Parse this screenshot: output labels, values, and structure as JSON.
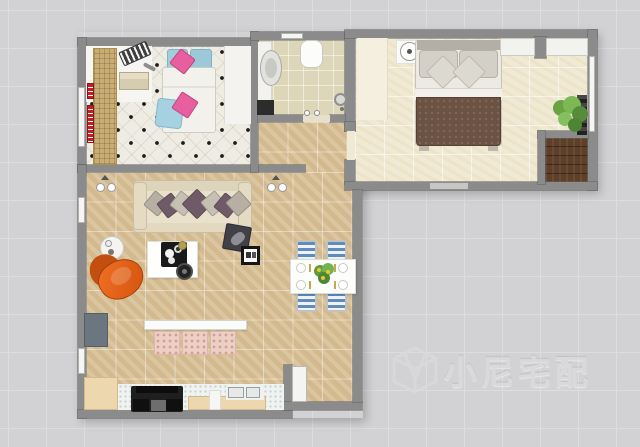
{
  "canvas": {
    "type": "home-design-floor-plan",
    "watermark_text": "小尼宅配",
    "background_color": "#d2d2d4",
    "grid_color": "#dddddf"
  },
  "palette": {
    "wall": "#8b8b8b",
    "living_floor": "#d8c097",
    "left_bedroom_floor": "#efece4",
    "right_bedroom_floor": "#f0e9d3",
    "bathroom_floor": "#ddd6b8",
    "balcony_wood": "#5e3f27",
    "sofa_cream": "#e9e1cb",
    "pillow_purple": "#6f5a67",
    "armchair_orange": "#e2601a",
    "bed_blanket_brown": "#6b5243",
    "pillow_pink": "#e75f9f",
    "pillow_blue": "#a2cddb",
    "dining_chair_blue": "#5f8cba",
    "red_wall_rack": "#c51f26",
    "tv_gray": "#6b7680",
    "counter_wood": "#ecd7ae"
  },
  "rooms": [
    {
      "name": "left-bedroom",
      "furniture": [
        "single-bed",
        "blue-pillows",
        "pink-pillows",
        "desk",
        "keyboard",
        "bench",
        "wicker-shelf",
        "red-wall-rack",
        "wardrobe",
        "window"
      ]
    },
    {
      "name": "bathroom",
      "furniture": [
        "vanity-counter",
        "washbasin",
        "bathtub",
        "shower-head",
        "bath-mat",
        "door-opening",
        "window"
      ]
    },
    {
      "name": "right-bedroom",
      "furniture": [
        "double-bed",
        "gray-pillows",
        "brown-blanket",
        "ceiling-fan",
        "closet-shelves",
        "area-rug",
        "potted-plant",
        "plant-stand",
        "windows"
      ]
    },
    {
      "name": "balcony",
      "furniture": [
        "wood-deck"
      ]
    },
    {
      "name": "living-room",
      "furniture": [
        "sofa",
        "throw-pillows",
        "coffee-table",
        "serving-tray",
        "speaker",
        "round-side-table",
        "orange-armchair",
        "tv-panel",
        "media-console",
        "curtain-drawers",
        "dark-side-table",
        "frame-tray-table",
        "wall-lamps",
        "windows"
      ]
    },
    {
      "name": "dining-area",
      "furniture": [
        "dining-table",
        "dining-chairs",
        "plates",
        "table-plant",
        "entry-door"
      ]
    },
    {
      "name": "kitchen",
      "furniture": [
        "wood-cabinet",
        "countertop",
        "stove",
        "double-sink"
      ]
    }
  ]
}
